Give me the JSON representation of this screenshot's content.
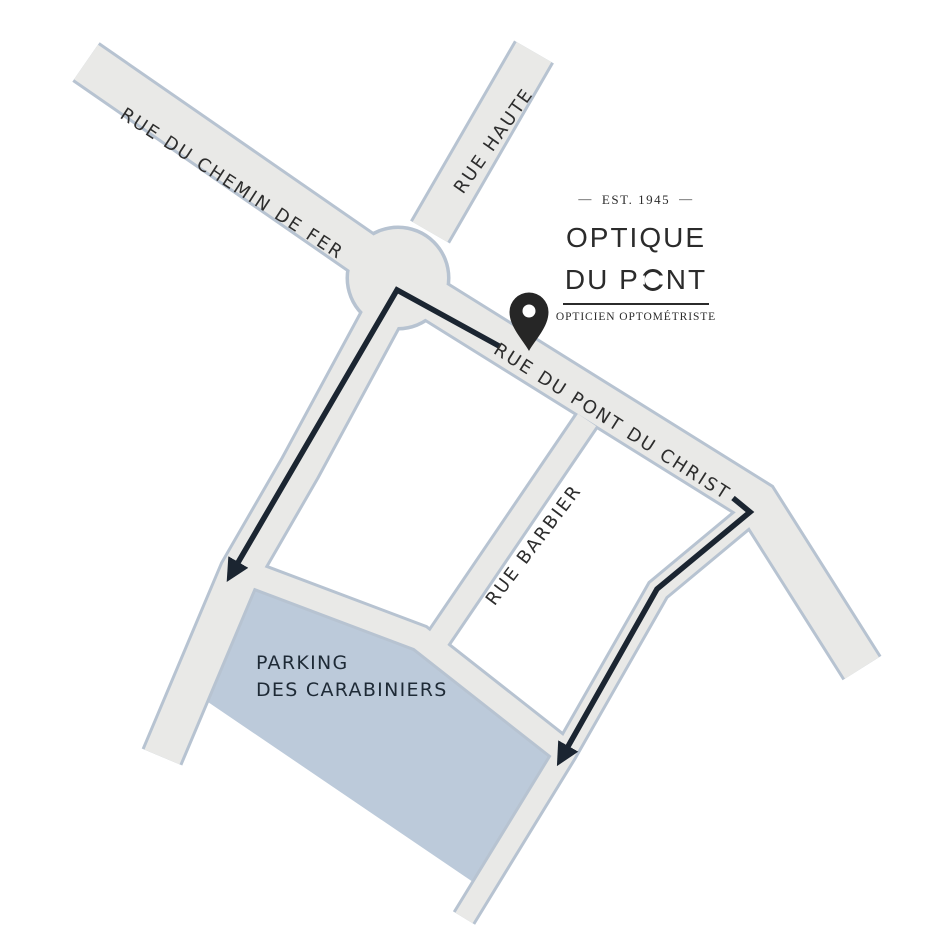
{
  "logo": {
    "dash": "—",
    "established": "EST. 1945",
    "title_line1": "OPTIQUE",
    "title_line2_before_o": "DU P",
    "title_line2_after_o": "NT",
    "subtitle": "OPTICIEN OPTOMÉTRISTE"
  },
  "map": {
    "streets": [
      {
        "id": "rue-du-chemin-de-fer",
        "label": "RUE DU CHEMIN DE FER"
      },
      {
        "id": "rue-haute",
        "label": "RUE HAUTE"
      },
      {
        "id": "rue-du-pont-du-christ",
        "label": "RUE DU PONT DU CHRIST"
      },
      {
        "id": "rue-barbier",
        "label": "RUE BARBIER"
      }
    ],
    "parking": {
      "line1": "PARKING",
      "line2": "DES CARABINIERS"
    },
    "marker": "location pin on Rue du Pont du Christ",
    "routes": [
      {
        "path": "from shop past roundabout down to parking north-west corner"
      },
      {
        "path": "from east end of Rue du Pont du Christ down side street to parking south-east corner"
      }
    ]
  },
  "colors": {
    "street_fill": "#e9e9e7",
    "street_border": "#b7c3d1",
    "parking_fill": "#bccada",
    "route": "#1b2531",
    "pin": "#262626",
    "pin_hole": "#ffffff",
    "street_text": "#2d2d2d",
    "parking_text": "#1e2a36",
    "logo_text": "#2b2b2b",
    "background": "#ffffff"
  }
}
